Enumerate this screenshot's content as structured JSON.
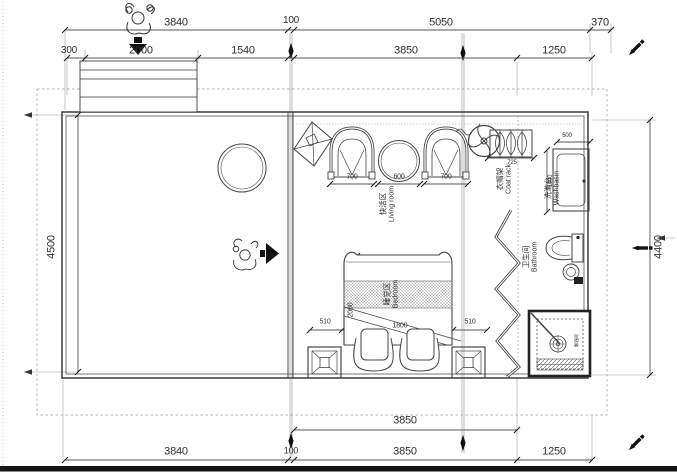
{
  "drawing": {
    "dimensions": {
      "top_row_1": [
        "3840",
        "100",
        "5050",
        "370"
      ],
      "top_row_2": [
        "300",
        "2000",
        "1540",
        "3850",
        "1250"
      ],
      "side_left": "4500",
      "side_right": "4400",
      "bottom_row_1": [
        "3850"
      ],
      "bottom_row_2": [
        "3840",
        "100",
        "3850",
        "1250"
      ]
    },
    "furniture_dimensions": {
      "armchair_left": "700",
      "tea_table": "600",
      "armchair_right": "700",
      "coat_rack": "725",
      "washbasin_width": "500",
      "washbasin_length": "1000",
      "bed_gap_left": "510",
      "bed_width": "1800",
      "bed_gap_right": "510",
      "bed_length": "2000"
    },
    "rooms": {
      "living": {
        "zh": "快活区",
        "en": "Living room"
      },
      "bedroom": {
        "zh": "睡觉区",
        "en": "Bedroom"
      },
      "washbasin": {
        "zh": "洗漱台",
        "en": "Washbasin"
      },
      "coat_rack": {
        "zh": "衣帽架",
        "en": "Coat rack"
      },
      "bathroom": {
        "zh": "卫生间",
        "en": "Bathroom"
      },
      "shower": {
        "zh": "淋浴间"
      }
    },
    "icons": [
      "person-pushing-icon",
      "down-arrow-icon",
      "person-top-view-icon",
      "right-arrow-icon",
      "pen-icon",
      "fan-icon",
      "kite-decor-icon"
    ],
    "colors": {
      "line": "#454545",
      "text": "#2f2f2f",
      "background": "#ffffff",
      "ink": "#111111"
    }
  }
}
